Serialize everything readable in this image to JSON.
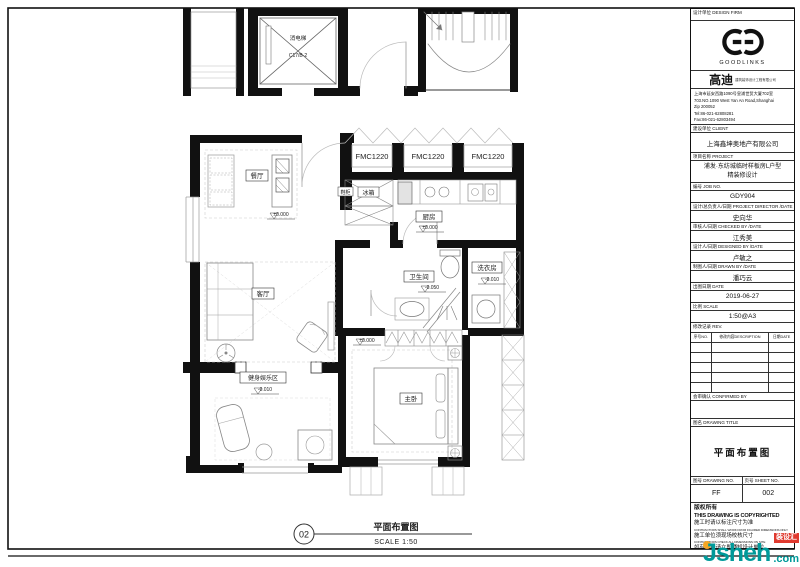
{
  "plan": {
    "rooms": {
      "dining": "餐厅",
      "living": "客厅",
      "kitchen": "厨房",
      "bathroom": "卫生间",
      "laundry": "洗衣房",
      "master_bedroom": "主卧",
      "fitness": "健身娱乐区",
      "fridge": "冰箱",
      "shoe_cabinet": "鞋柜",
      "elevator": "消电梯",
      "elevator_code": "C17/B-2"
    },
    "window_tags": [
      "FMC1220",
      "FMC1220",
      "FMC1220"
    ],
    "levels": {
      "dining": "±0.000",
      "kitchen": "±0.000",
      "master": "±0.000",
      "bathroom": "-0.050",
      "laundry": "-0.010",
      "fitness": "-0.010"
    },
    "caption": {
      "number": "02",
      "title": "平面布置图",
      "scale": "SCALE 1:50"
    }
  },
  "titleblock": {
    "design_firm_label": "设计单位 DESIGN FIRM",
    "brand": {
      "name": "GOODLINKS",
      "cn": "高迪",
      "cn_sub": "建筑装饰设计工程有限公司"
    },
    "address": [
      "上海市延安西路1090号皇浦世贸大厦702室",
      "703.NO.1090 West Yan An Road,Shanghai",
      "Zip 200052",
      "Tel:86-021-62808281",
      "Fax:86-021-62803494",
      "Email:goodlinksvip.163.com"
    ],
    "client_label": "建设单位 CLIENT",
    "client": "上海鑫坤奥地产有限公司",
    "project_label": "项目名称 PROJECT",
    "project_line1": "浦发·东纺城临时样板房L户型",
    "project_line2": "精装修设计",
    "job_label": "编号 JOB NO.",
    "job_no": "GDY904",
    "director_label": "设计/总负责人/日期 PROJECT DIRECTOR /DATE",
    "director": "史向华",
    "checker_label": "审核人/日期 CHECKED BY /DATE",
    "checker": "江秀美",
    "designer_label": "设计人/日期 DESIGNED BY /DATE",
    "designer": "卢敏之",
    "drafter_label": "制图人/日期 DRAWN BY /DATE",
    "drafter": "潘巧云",
    "date_label": "出图日期 DATE",
    "date": "2019-06-27",
    "scale_label": "比例 SCALE",
    "scale": "1:50@A3",
    "rev_label": "修改记录 REV.",
    "rev_cols": {
      "no": "序号NO.",
      "desc": "修改内容DESCRIPTION",
      "date": "日期DATE"
    },
    "confirmed_label": "会审确认 CONFIRMED BY",
    "drawing_title_label": "图名 DRAWING TITLE",
    "drawing_title": "平面布置图",
    "drawing_no_label": "图号 DRAWING NO.",
    "drawing_no": "FF",
    "sheet_no_label": "页号 SHEET NO.",
    "sheet_no": "002",
    "copyright": [
      "版权所有",
      "THIS DRAWING IS COPYRIGHTED",
      "施工时请以标注尺寸为准",
      "CONTRACTORS SHALL WORK FROM FIGURED DIMENSIONS ONLY",
      "施工单位须现场校核尺寸",
      "CONTRACTORS CHECK ALL DIMENSIONS ON SITE",
      "如有不符请立即通知设计单位",
      "DISCREPANCIES SHOULD BE REPORTED IMMEDIATELY"
    ]
  },
  "watermark": {
    "name": "Jsheh",
    "tld": ".com",
    "badge": "装设汇",
    "text_color": "#009a9a",
    "badge_color": "#e03a2f",
    "dot_color": "#f5a623"
  }
}
